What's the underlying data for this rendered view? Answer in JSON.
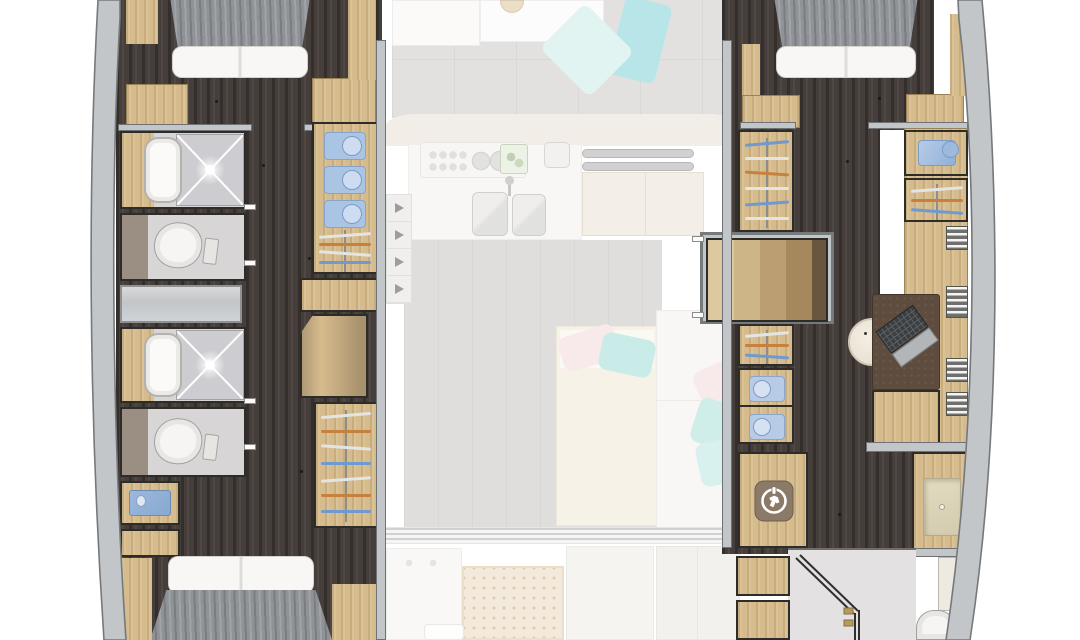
{
  "legend": {
    "view": "Top-down yacht catamaran floor plan, lower deck in full color, main deck furniture shown faded",
    "decks": [
      "lower-deck-hulls",
      "main-deck-faded"
    ]
  },
  "colors": {
    "bg": "#ffffff",
    "hull-wall": "#c3c6c8",
    "hull-wall-edge": "#75797c",
    "wall-dark": "#2e2c29",
    "floor-dark": "#463e3a",
    "wood": "#d6bb8d",
    "wood-dark": "#bb9e70",
    "bath-floor": "#d8d5d6",
    "shower-floor": "#cdccd0",
    "duvet": "#8f9296",
    "pillow": "#f8f7f5",
    "teal": "#7fcfd3",
    "teal-light": "#c9ece7",
    "pink": "#f3d9da",
    "shirt-blue": "#aac4e3",
    "accent-blue": "#6f9ad0",
    "accent-orange": "#c8803f",
    "basin-blue": "#9db9dc",
    "desk-brown": "#5e4c3e",
    "icon-taupe": "#8b7a67",
    "deck-gray": "#cac9c7",
    "deck-beige": "#e7dfd2",
    "teak": "#ead9bd"
  },
  "port_hull": {
    "fore_cabin": {
      "furniture": [
        "double-bed",
        "side-benches"
      ]
    },
    "bathroom_fwd": {
      "fixtures": [
        "vanity-sink",
        "shower",
        "toilet"
      ]
    },
    "bathroom_aft": {
      "fixtures": [
        "vanity-sink",
        "shower",
        "toilet"
      ]
    },
    "washbasin_cabinet": {
      "fixtures": [
        "blue-basin"
      ]
    },
    "aft_cabin": {
      "furniture": [
        "double-bed"
      ]
    },
    "storage": {
      "folded_shirts": 3,
      "hanging_lockers": 2
    },
    "stairs": {
      "direction_arrows": 4
    }
  },
  "starboard_hull": {
    "fore_cabin": {
      "furniture": [
        "double-bed",
        "side-benches"
      ]
    },
    "walk_in_closet": {
      "hanging_rails": 3,
      "folded_towels": 2,
      "storage_box": 1,
      "vent_shelves": 4
    },
    "office": {
      "furniture": [
        "desk",
        "laptop",
        "round-stool"
      ]
    },
    "utility": {
      "appliance": "washing-machine"
    },
    "bathroom": {
      "fixtures": [
        "vanity-sink",
        "shower",
        "toilet"
      ]
    },
    "stairs": {
      "steps": 4
    }
  },
  "main_deck_faded": {
    "saloon": {
      "furniture": [
        "sectional-sofa",
        "dining-table",
        "cabinet",
        "chaise-lounge",
        "settee"
      ],
      "pillows": {
        "teal": 4,
        "pink": 2
      }
    },
    "galley": {
      "equipment": [
        "cooktop-3-burner",
        "control-knobs-8",
        "cutting-board",
        "prep-sink",
        "double-sink",
        "handrails-2"
      ]
    },
    "cockpit": {
      "furniture": [
        "bench",
        "teak-table",
        "seating-modules"
      ]
    },
    "sliding_door_tracks": 3
  }
}
